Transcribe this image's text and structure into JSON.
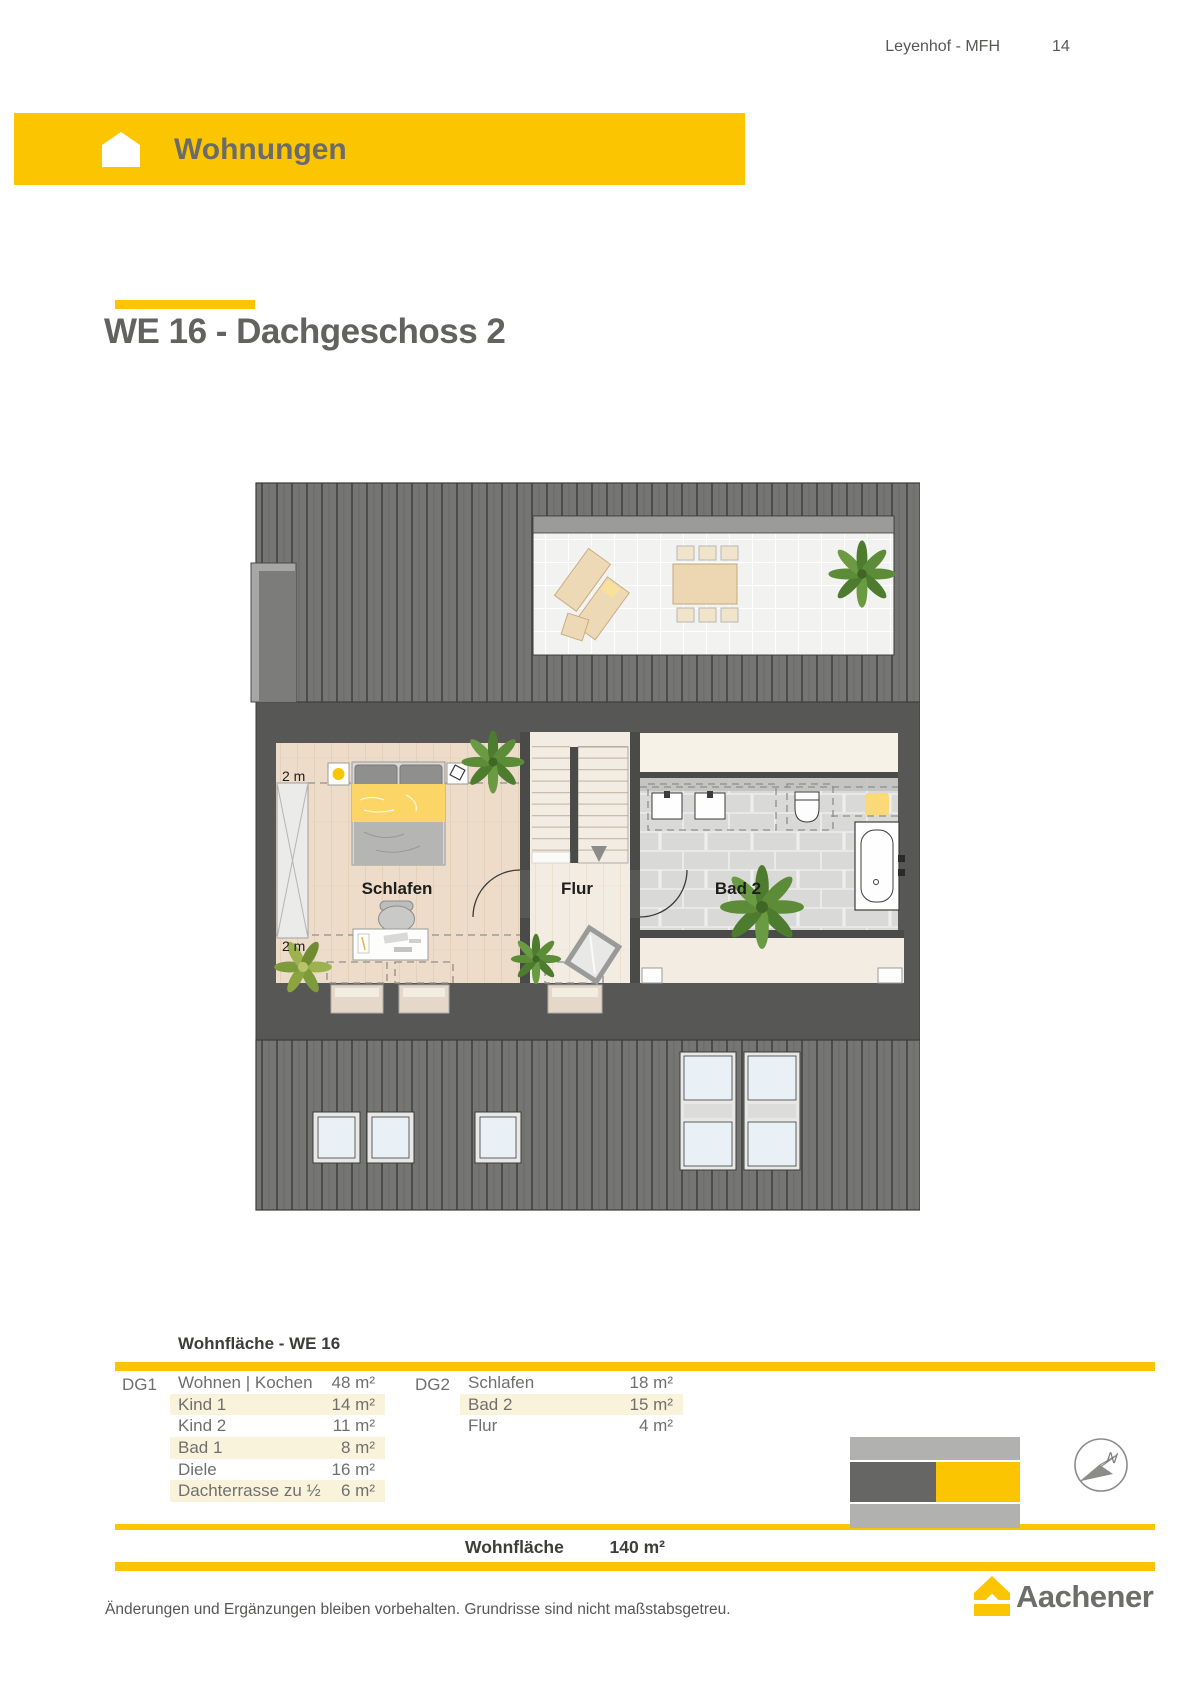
{
  "page_header": {
    "project": "Leyenhof - MFH",
    "page_number": "14"
  },
  "banner": {
    "label": "Wohnungen",
    "icon": "house-icon"
  },
  "section": {
    "title": "WE 16 - Dachgeschoss 2"
  },
  "floorplan": {
    "rooms": {
      "bedroom": "Schlafen",
      "hallway": "Flur",
      "bathroom": "Bad 2"
    },
    "height_marker_top": "2 m",
    "height_marker_bottom": "2 m"
  },
  "area_table": {
    "caption": "Wohnfläche - WE 16",
    "groups": [
      {
        "floor": "DG1",
        "rows": [
          [
            "Wohnen | Kochen",
            "48 m²"
          ],
          [
            "Kind 1",
            "14 m²"
          ],
          [
            "Kind 2",
            "11 m²"
          ],
          [
            "Bad 1",
            "8 m²"
          ],
          [
            "Diele",
            "16 m²"
          ],
          [
            "Dachterrasse zu ½",
            "6 m²"
          ]
        ]
      },
      {
        "floor": "DG2",
        "rows": [
          [
            "Schlafen",
            "18 m²"
          ],
          [
            "Bad 2",
            "15 m²"
          ],
          [
            "Flur",
            "4 m²"
          ]
        ]
      }
    ],
    "total_label": "Wohnfläche",
    "total_value": "140 m²"
  },
  "compass": {
    "label": "N"
  },
  "footer": {
    "disclaimer": "Änderungen und Ergänzungen bleiben vorbehalten. Grundrisse sind nicht maßstabsgetreu.",
    "brand": "Aachener"
  },
  "colors": {
    "accent": "#FCC502",
    "dark_gray": "#575756",
    "roof_gray": "#757574",
    "row_highlight": "#FAF3DC"
  }
}
